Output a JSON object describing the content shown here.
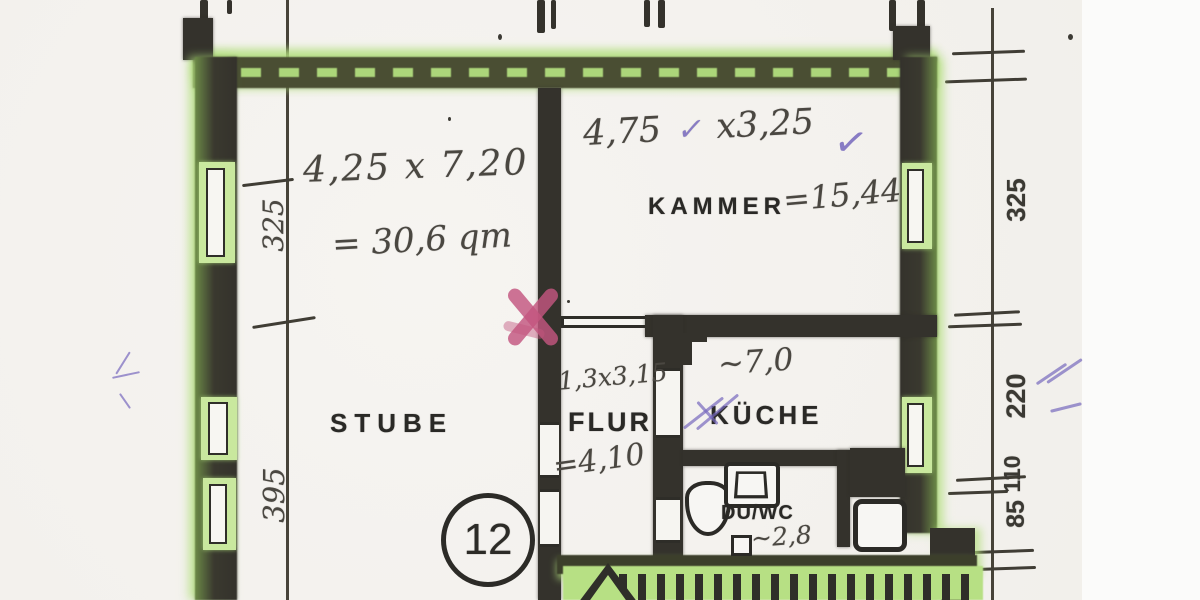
{
  "document": {
    "type": "scanned floor plan (hand-annotated)",
    "unit_badge": "12"
  },
  "rooms": {
    "stube": {
      "label": "STUBE",
      "size": "4,25 x 7,20",
      "area": "= 30,6 qm"
    },
    "kammer": {
      "label": "KAMMER",
      "size_a": "4,75",
      "size_b": "x3,25",
      "area": "=15,44"
    },
    "flur": {
      "label": "FLUR",
      "size": "1,3x3,15",
      "area": "=4,10"
    },
    "kueche": {
      "label": "KÜCHE",
      "area": "~7,0"
    },
    "duwc": {
      "label": "DU/WC",
      "area": "~2,8"
    }
  },
  "dimensions": {
    "left": {
      "d1": "325",
      "d2": "395"
    },
    "right": {
      "d1": "325",
      "d2": "220",
      "d3": "110",
      "d4": "85"
    }
  },
  "marks": {
    "check": "✓"
  },
  "colors": {
    "highlighter_green": "#b5df82",
    "wall_dark": "#34322c",
    "pink_cross": "#c3567f",
    "purple_pen": "#7668bd",
    "paper": "#f3f1ed"
  }
}
